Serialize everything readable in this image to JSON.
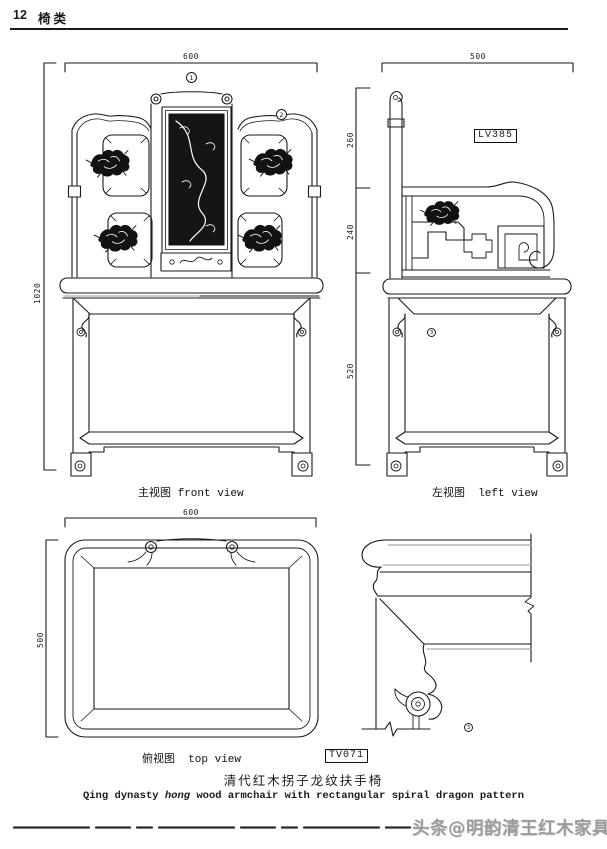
{
  "colors": {
    "ink": "#1a1a1a",
    "gray_accent": "#9a9a9a",
    "watermark_gray": "#9b9b9b",
    "paper": "#ffffff"
  },
  "header": {
    "page_number": "12",
    "category": "椅类"
  },
  "front_view": {
    "dim_width": "600",
    "dim_height": "1020",
    "marker_1": "1",
    "marker_2": "2",
    "caption": "主视图 front view"
  },
  "left_view": {
    "dim_width": "500",
    "dim_upper": "260",
    "dim_middle": "240",
    "dim_lower": "520",
    "code": "LV385",
    "marker_3": "3",
    "caption": "左视图  left view"
  },
  "top_view": {
    "dim_width": "600",
    "dim_depth": "500",
    "caption": "俯视图  top view"
  },
  "detail_view": {
    "marker": "3"
  },
  "footer": {
    "code": "TV071",
    "title_zh": "清代红木拐子龙纹扶手椅",
    "title_en_prefix": "Qing dynasty ",
    "title_en_italic": "hong",
    "title_en_suffix": " wood armchair with rectangular spiral dragon pattern",
    "watermark": "头条@明韵清王红木家具"
  }
}
